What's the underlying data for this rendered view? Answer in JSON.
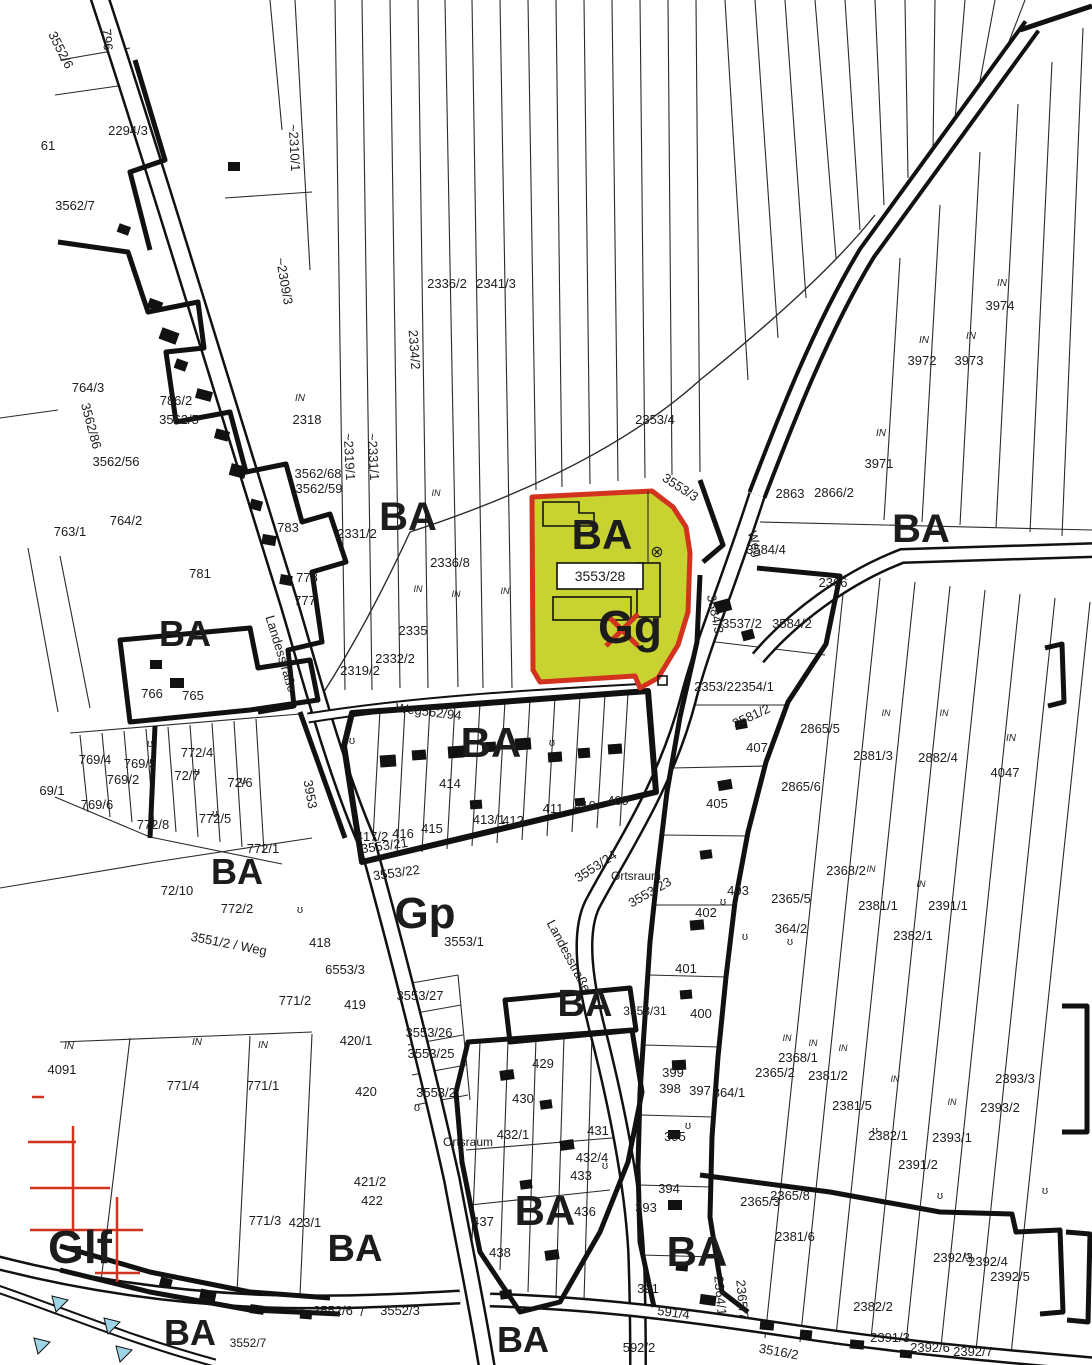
{
  "map": {
    "type": "cadastral-parcel-map",
    "colors": {
      "ink": "#1c1c1c",
      "red": "#d2331f",
      "blue": "#9fd4e6",
      "highlight_fill": "#c8d231",
      "highlight_stroke": "#d2331f",
      "paper": "#ffffff"
    },
    "highlight": {
      "parcel_id": "3553/28",
      "zone_label": "BA",
      "use_label": "Gg",
      "symbol": "⊗"
    },
    "streets": [
      "Landesstraße",
      "Weg",
      "Ortsraum"
    ],
    "zone_codes": [
      "BA",
      "Gp",
      "Glf",
      "Gg"
    ],
    "labels": [
      {
        "t": "BA",
        "x": 408,
        "y": 530,
        "s": 40,
        "w": 1
      },
      {
        "t": "BA",
        "x": 921,
        "y": 542,
        "s": 40,
        "w": 1
      },
      {
        "t": "BA",
        "x": 602,
        "y": 549,
        "s": 42,
        "w": 1,
        "c": "#d2331f"
      },
      {
        "t": "BA",
        "x": 185,
        "y": 646,
        "s": 36,
        "w": 1
      },
      {
        "t": "BA",
        "x": 491,
        "y": 757,
        "s": 42,
        "w": 1
      },
      {
        "t": "BA",
        "x": 237,
        "y": 884,
        "s": 36,
        "w": 1
      },
      {
        "t": "Gp",
        "x": 425,
        "y": 928,
        "s": 44,
        "w": 1
      },
      {
        "t": "BA",
        "x": 585,
        "y": 1016,
        "s": 38,
        "w": 1
      },
      {
        "t": "BA",
        "x": 545,
        "y": 1225,
        "s": 42,
        "w": 1
      },
      {
        "t": "BA",
        "x": 697,
        "y": 1266,
        "s": 42,
        "w": 1
      },
      {
        "t": "BA",
        "x": 355,
        "y": 1261,
        "s": 38,
        "w": 1
      },
      {
        "t": "Glf",
        "x": 80,
        "y": 1263,
        "s": 46,
        "w": 1
      },
      {
        "t": "BA",
        "x": 190,
        "y": 1345,
        "s": 36,
        "w": 1
      },
      {
        "t": "BA",
        "x": 523,
        "y": 1352,
        "s": 36,
        "w": 1
      },
      {
        "t": "Gg",
        "x": 630,
        "y": 643,
        "s": 46,
        "w": 1
      },
      {
        "t": "3553/28",
        "x": 600,
        "y": 581,
        "s": 14
      },
      {
        "t": "⊗",
        "x": 657,
        "y": 557,
        "s": 16
      },
      {
        "t": "2294/3",
        "x": 128,
        "y": 135
      },
      {
        "t": "796",
        "x": 103,
        "y": 40,
        "r": 85
      },
      {
        "t": "3552/6",
        "x": 57,
        "y": 52,
        "r": 63
      },
      {
        "t": "61",
        "x": 48,
        "y": 150
      },
      {
        "t": "3562/7",
        "x": 75,
        "y": 210
      },
      {
        "t": "~2310/1",
        "x": 290,
        "y": 148,
        "r": 87
      },
      {
        "t": "~2309/3",
        "x": 280,
        "y": 282,
        "r": 80
      },
      {
        "t": "2336/2",
        "x": 447,
        "y": 288
      },
      {
        "t": "2341/3",
        "x": 496,
        "y": 288
      },
      {
        "t": "2334/2",
        "x": 410,
        "y": 350,
        "r": 86
      },
      {
        "t": "~2331/1",
        "x": 369,
        "y": 457,
        "r": 87
      },
      {
        "t": "2353/4",
        "x": 655,
        "y": 424
      },
      {
        "t": "IN",
        "x": 1002,
        "y": 286,
        "s": 10,
        "i": 1
      },
      {
        "t": "3974",
        "x": 1000,
        "y": 310
      },
      {
        "t": "IN",
        "x": 924,
        "y": 343,
        "s": 10,
        "i": 1
      },
      {
        "t": "3972",
        "x": 922,
        "y": 365
      },
      {
        "t": "IN",
        "x": 971,
        "y": 339,
        "s": 10,
        "i": 1
      },
      {
        "t": "3973",
        "x": 969,
        "y": 365
      },
      {
        "t": "IN",
        "x": 881,
        "y": 436,
        "s": 10,
        "i": 1
      },
      {
        "t": "3971",
        "x": 879,
        "y": 468
      },
      {
        "t": "IN",
        "x": 300,
        "y": 401,
        "s": 10,
        "i": 1
      },
      {
        "t": "2318",
        "x": 307,
        "y": 424
      },
      {
        "t": "~2319/1",
        "x": 345,
        "y": 457,
        "r": 87
      },
      {
        "t": "3562/68",
        "x": 318,
        "y": 478
      },
      {
        "t": "3562/59",
        "x": 319,
        "y": 493
      },
      {
        "t": "764/3",
        "x": 88,
        "y": 392
      },
      {
        "t": "3562/86",
        "x": 87,
        "y": 427,
        "r": 75
      },
      {
        "t": "786/2",
        "x": 176,
        "y": 405
      },
      {
        "t": "3562/5",
        "x": 179,
        "y": 424
      },
      {
        "t": "3562/56",
        "x": 116,
        "y": 466
      },
      {
        "t": "763/1",
        "x": 70,
        "y": 536
      },
      {
        "t": "764/2",
        "x": 126,
        "y": 525
      },
      {
        "t": "783",
        "x": 288,
        "y": 532
      },
      {
        "t": "781",
        "x": 200,
        "y": 578
      },
      {
        "t": "778",
        "x": 307,
        "y": 582
      },
      {
        "t": "777",
        "x": 305,
        "y": 605
      },
      {
        "t": "2331/2",
        "x": 357,
        "y": 538
      },
      {
        "t": "2336/8",
        "x": 450,
        "y": 567
      },
      {
        "t": "2335",
        "x": 413,
        "y": 635
      },
      {
        "t": "2332/2",
        "x": 395,
        "y": 663
      },
      {
        "t": "2319/2",
        "x": 360,
        "y": 675
      },
      {
        "t": "Weg562/94",
        "x": 428,
        "y": 716,
        "r": 7
      },
      {
        "t": "Landesstraße",
        "x": 277,
        "y": 655,
        "r": 73
      },
      {
        "t": "3953",
        "x": 306,
        "y": 795,
        "r": 80
      },
      {
        "t": "2863",
        "x": 790,
        "y": 498
      },
      {
        "t": "2866/2",
        "x": 834,
        "y": 497
      },
      {
        "t": "3584/4",
        "x": 766,
        "y": 554
      },
      {
        "t": "2366",
        "x": 833,
        "y": 587
      },
      {
        "t": "3537/2",
        "x": 742,
        "y": 628
      },
      {
        "t": "3584/2",
        "x": 792,
        "y": 628
      },
      {
        "t": "2353/2",
        "x": 714,
        "y": 691
      },
      {
        "t": "2354/1",
        "x": 754,
        "y": 691
      },
      {
        "t": "3581/2",
        "x": 753,
        "y": 720,
        "r": -25
      },
      {
        "t": "3584/3",
        "x": 711,
        "y": 615,
        "r": 78
      },
      {
        "t": "Weg",
        "x": 751,
        "y": 545,
        "r": 75
      },
      {
        "t": "3553/3",
        "x": 678,
        "y": 491,
        "r": 33
      },
      {
        "t": "2381/3",
        "x": 873,
        "y": 760
      },
      {
        "t": "2882/4",
        "x": 938,
        "y": 762
      },
      {
        "t": "IN",
        "x": 1011,
        "y": 741,
        "s": 10,
        "i": 1
      },
      {
        "t": "4047",
        "x": 1005,
        "y": 777
      },
      {
        "t": "2368/2",
        "x": 846,
        "y": 875
      },
      {
        "t": "2381/1",
        "x": 878,
        "y": 910
      },
      {
        "t": "2391/1",
        "x": 948,
        "y": 910
      },
      {
        "t": "2382/1",
        "x": 913,
        "y": 940
      },
      {
        "t": "IN",
        "x": 886,
        "y": 716,
        "s": 9,
        "i": 1
      },
      {
        "t": "IN",
        "x": 944,
        "y": 716,
        "s": 9,
        "i": 1
      },
      {
        "t": "IN",
        "x": 871,
        "y": 872,
        "s": 9,
        "i": 1
      },
      {
        "t": "IN",
        "x": 921,
        "y": 887,
        "s": 9,
        "i": 1
      },
      {
        "t": "407",
        "x": 757,
        "y": 752
      },
      {
        "t": "405",
        "x": 717,
        "y": 808
      },
      {
        "t": "2865/5",
        "x": 820,
        "y": 733
      },
      {
        "t": "2865/6",
        "x": 801,
        "y": 791
      },
      {
        "t": "414",
        "x": 450,
        "y": 788
      },
      {
        "t": "415",
        "x": 432,
        "y": 833
      },
      {
        "t": "416",
        "x": 403,
        "y": 838
      },
      {
        "t": "417/2",
        "x": 372,
        "y": 841
      },
      {
        "t": "413/1",
        "x": 489,
        "y": 824
      },
      {
        "t": "412",
        "x": 513,
        "y": 825
      },
      {
        "t": "411",
        "x": 553,
        "y": 813
      },
      {
        "t": "410",
        "x": 585,
        "y": 810
      },
      {
        "t": "409",
        "x": 618,
        "y": 805
      },
      {
        "t": "3553/21",
        "x": 385,
        "y": 850,
        "r": -8
      },
      {
        "t": "3553/22",
        "x": 397,
        "y": 877,
        "r": -8
      },
      {
        "t": "3553/24",
        "x": 598,
        "y": 870,
        "r": -33
      },
      {
        "t": "Ortsraum",
        "x": 636,
        "y": 880,
        "s": 12
      },
      {
        "t": "3553/23",
        "x": 652,
        "y": 896,
        "r": -30
      },
      {
        "t": "Landesstraße",
        "x": 565,
        "y": 958,
        "r": 62
      },
      {
        "t": "Ortsraum",
        "x": 468,
        "y": 1146,
        "s": 12
      },
      {
        "t": "766",
        "x": 152,
        "y": 698
      },
      {
        "t": "765",
        "x": 193,
        "y": 700
      },
      {
        "t": "769/4",
        "x": 95,
        "y": 764
      },
      {
        "t": "769/5",
        "x": 140,
        "y": 768
      },
      {
        "t": "769/2",
        "x": 123,
        "y": 784
      },
      {
        "t": "769/6",
        "x": 97,
        "y": 809
      },
      {
        "t": "69/1",
        "x": 52,
        "y": 795
      },
      {
        "t": "772/4",
        "x": 197,
        "y": 757
      },
      {
        "t": "72/7",
        "x": 187,
        "y": 780
      },
      {
        "t": "72/6",
        "x": 240,
        "y": 787
      },
      {
        "t": "772/5",
        "x": 215,
        "y": 823
      },
      {
        "t": "772/8",
        "x": 153,
        "y": 829
      },
      {
        "t": "772/1",
        "x": 263,
        "y": 853
      },
      {
        "t": "72/10",
        "x": 177,
        "y": 895
      },
      {
        "t": "772/2",
        "x": 237,
        "y": 913
      },
      {
        "t": "3551/2 / Weg",
        "x": 228,
        "y": 948,
        "r": 11
      },
      {
        "t": "418",
        "x": 320,
        "y": 947
      },
      {
        "t": "6553/3",
        "x": 345,
        "y": 974
      },
      {
        "t": "3553/1",
        "x": 464,
        "y": 946
      },
      {
        "t": "771/2",
        "x": 295,
        "y": 1005
      },
      {
        "t": "419",
        "x": 355,
        "y": 1009
      },
      {
        "t": "420/1",
        "x": 356,
        "y": 1045
      },
      {
        "t": "420",
        "x": 366,
        "y": 1096
      },
      {
        "t": "3553/27",
        "x": 420,
        "y": 1000
      },
      {
        "t": "3553/26",
        "x": 429,
        "y": 1037
      },
      {
        "t": "3553/25",
        "x": 431,
        "y": 1058
      },
      {
        "t": "3553/2",
        "x": 436,
        "y": 1097
      },
      {
        "t": "IN",
        "x": 69,
        "y": 1049,
        "s": 10,
        "i": 1
      },
      {
        "t": "4091",
        "x": 62,
        "y": 1074
      },
      {
        "t": "IN",
        "x": 197,
        "y": 1045,
        "s": 10,
        "i": 1
      },
      {
        "t": "771/4",
        "x": 183,
        "y": 1090
      },
      {
        "t": "IN",
        "x": 263,
        "y": 1048,
        "s": 10,
        "i": 1
      },
      {
        "t": "771/1",
        "x": 263,
        "y": 1090
      },
      {
        "t": "771/3",
        "x": 265,
        "y": 1225
      },
      {
        "t": "421/2",
        "x": 370,
        "y": 1186
      },
      {
        "t": "422",
        "x": 372,
        "y": 1205
      },
      {
        "t": "423/1",
        "x": 305,
        "y": 1227
      },
      {
        "t": "3552/7",
        "x": 248,
        "y": 1347,
        "s": 12
      },
      {
        "t": "3552/6",
        "x": 333,
        "y": 1315
      },
      {
        "t": "/",
        "x": 362,
        "y": 1316
      },
      {
        "t": "3552/3",
        "x": 400,
        "y": 1315
      },
      {
        "t": "429",
        "x": 543,
        "y": 1068
      },
      {
        "t": "430",
        "x": 523,
        "y": 1103
      },
      {
        "t": "432/1",
        "x": 513,
        "y": 1139
      },
      {
        "t": "431",
        "x": 598,
        "y": 1135
      },
      {
        "t": "432/4",
        "x": 592,
        "y": 1162
      },
      {
        "t": "433",
        "x": 581,
        "y": 1180
      },
      {
        "t": "436",
        "x": 585,
        "y": 1216
      },
      {
        "t": "437",
        "x": 483,
        "y": 1226
      },
      {
        "t": "438",
        "x": 500,
        "y": 1257
      },
      {
        "t": "3553/31",
        "x": 645,
        "y": 1015,
        "s": 12
      },
      {
        "t": "401",
        "x": 686,
        "y": 973
      },
      {
        "t": "400",
        "x": 701,
        "y": 1018
      },
      {
        "t": "402",
        "x": 706,
        "y": 917
      },
      {
        "t": "403",
        "x": 738,
        "y": 895
      },
      {
        "t": "399",
        "x": 673,
        "y": 1077
      },
      {
        "t": "398",
        "x": 670,
        "y": 1093
      },
      {
        "t": "397",
        "x": 700,
        "y": 1095
      },
      {
        "t": "364/1",
        "x": 729,
        "y": 1097
      },
      {
        "t": "395",
        "x": 675,
        "y": 1141
      },
      {
        "t": "394",
        "x": 669,
        "y": 1193
      },
      {
        "t": "393",
        "x": 646,
        "y": 1212
      },
      {
        "t": "391",
        "x": 648,
        "y": 1293
      },
      {
        "t": "2365/5",
        "x": 791,
        "y": 903
      },
      {
        "t": "364/2",
        "x": 791,
        "y": 933
      },
      {
        "t": "2368/1",
        "x": 798,
        "y": 1062
      },
      {
        "t": "2365/2",
        "x": 775,
        "y": 1077
      },
      {
        "t": "2381/2",
        "x": 828,
        "y": 1080
      },
      {
        "t": "2381/5",
        "x": 852,
        "y": 1110
      },
      {
        "t": "2393/3",
        "x": 1015,
        "y": 1083
      },
      {
        "t": "2393/2",
        "x": 1000,
        "y": 1112
      },
      {
        "t": "2382/1",
        "x": 888,
        "y": 1140
      },
      {
        "t": "2393/1",
        "x": 952,
        "y": 1142
      },
      {
        "t": "2391/2",
        "x": 918,
        "y": 1169
      },
      {
        "t": "2365/3",
        "x": 760,
        "y": 1206
      },
      {
        "t": "2365/8",
        "x": 790,
        "y": 1200
      },
      {
        "t": "2381/6",
        "x": 795,
        "y": 1241
      },
      {
        "t": "2392/3",
        "x": 953,
        "y": 1262
      },
      {
        "t": "2392/4",
        "x": 988,
        "y": 1266
      },
      {
        "t": "2392/5",
        "x": 1010,
        "y": 1281
      },
      {
        "t": "2382/2",
        "x": 873,
        "y": 1311
      },
      {
        "t": "2391/3",
        "x": 890,
        "y": 1342
      },
      {
        "t": "2392/6",
        "x": 930,
        "y": 1352
      },
      {
        "t": "2392/7",
        "x": 973,
        "y": 1356
      },
      {
        "t": "2364/1",
        "x": 716,
        "y": 1296,
        "r": 85
      },
      {
        "t": "2365/7",
        "x": 738,
        "y": 1300,
        "r": 85
      },
      {
        "t": "591/4",
        "x": 673,
        "y": 1317,
        "r": 8
      },
      {
        "t": "592/2",
        "x": 639,
        "y": 1352
      },
      {
        "t": "3516/2",
        "x": 778,
        "y": 1356,
        "r": 10
      },
      {
        "t": "IN",
        "x": 787,
        "y": 1041,
        "s": 9,
        "i": 1
      },
      {
        "t": "IN",
        "x": 813,
        "y": 1046,
        "s": 9,
        "i": 1
      },
      {
        "t": "IN",
        "x": 843,
        "y": 1051,
        "s": 9,
        "i": 1
      },
      {
        "t": "IN",
        "x": 895,
        "y": 1082,
        "s": 9,
        "i": 1
      },
      {
        "t": "IN",
        "x": 952,
        "y": 1105,
        "s": 9,
        "i": 1
      },
      {
        "t": "IN",
        "x": 436,
        "y": 496,
        "s": 9,
        "i": 1
      },
      {
        "t": "IN",
        "x": 456,
        "y": 597,
        "s": 9,
        "i": 1
      },
      {
        "t": "IN",
        "x": 505,
        "y": 594,
        "s": 9,
        "i": 1
      },
      {
        "t": "IN",
        "x": 418,
        "y": 592,
        "s": 9,
        "i": 1
      },
      {
        "t": "ʊ",
        "x": 150,
        "y": 747,
        "s": 11
      },
      {
        "t": "ʊ",
        "x": 197,
        "y": 775,
        "s": 11
      },
      {
        "t": "ʊ",
        "x": 243,
        "y": 784,
        "s": 11
      },
      {
        "t": "ʊ",
        "x": 215,
        "y": 817,
        "s": 11
      },
      {
        "t": "ʊ",
        "x": 352,
        "y": 744,
        "s": 11
      },
      {
        "t": "ʊ",
        "x": 552,
        "y": 746,
        "s": 11
      },
      {
        "t": "ʊ",
        "x": 300,
        "y": 913,
        "s": 11
      },
      {
        "t": "ʊ",
        "x": 417,
        "y": 1111,
        "s": 11
      },
      {
        "t": "ʊ",
        "x": 605,
        "y": 1169,
        "s": 11
      },
      {
        "t": "ʊ",
        "x": 640,
        "y": 1236,
        "s": 11
      },
      {
        "t": "ʊ",
        "x": 688,
        "y": 1129,
        "s": 11
      },
      {
        "t": "ʊ",
        "x": 745,
        "y": 940,
        "s": 11
      },
      {
        "t": "ʊ",
        "x": 875,
        "y": 1134,
        "s": 11
      },
      {
        "t": "ʊ",
        "x": 940,
        "y": 1199,
        "s": 11
      },
      {
        "t": "ʊ",
        "x": 967,
        "y": 1259,
        "s": 11
      },
      {
        "t": "ʊ",
        "x": 1045,
        "y": 1194,
        "s": 11
      },
      {
        "t": "ʊ",
        "x": 790,
        "y": 945,
        "s": 11
      },
      {
        "t": "ʊ",
        "x": 723,
        "y": 905,
        "s": 11
      }
    ]
  }
}
